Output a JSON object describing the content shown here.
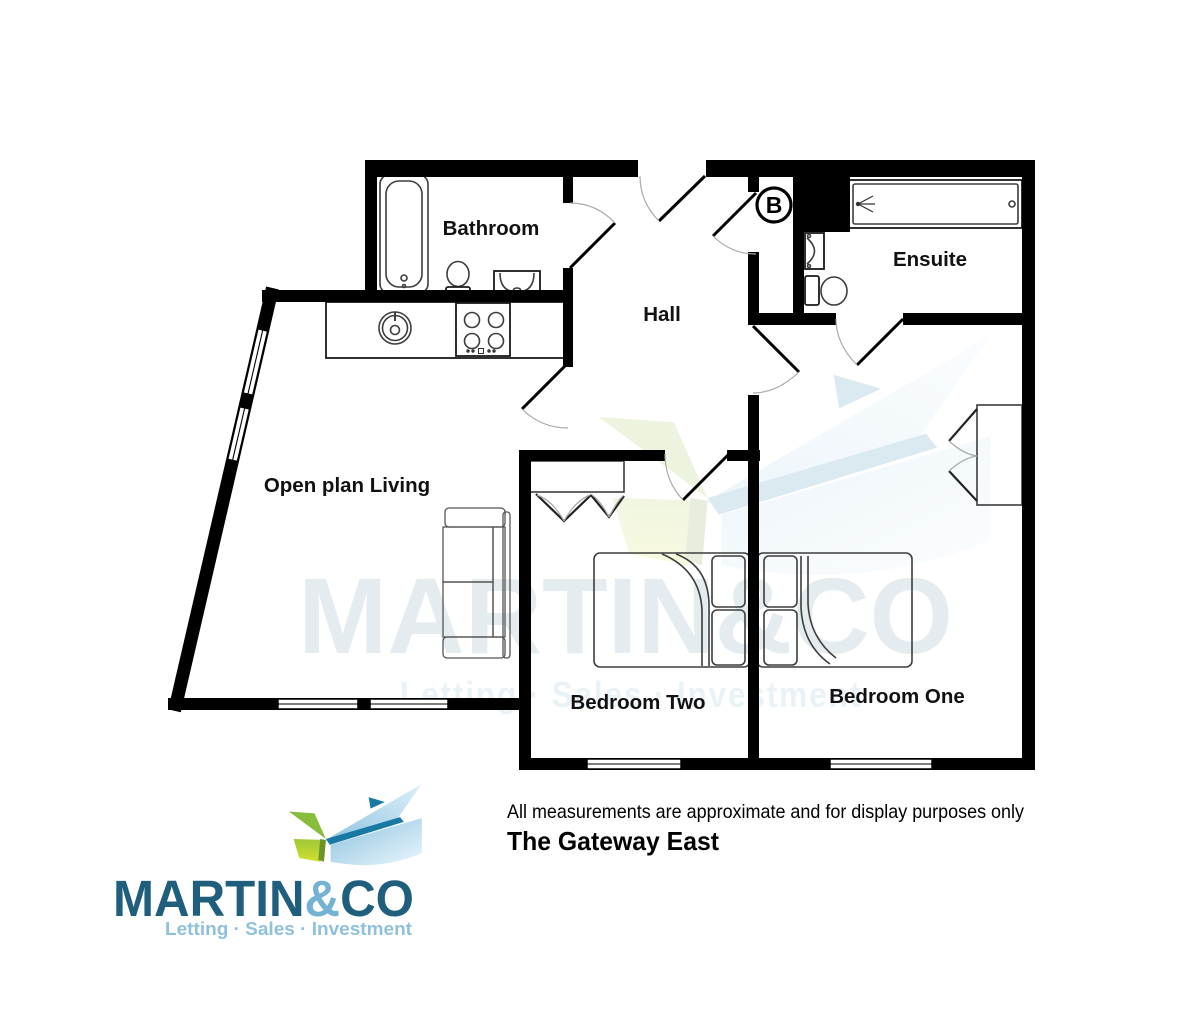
{
  "page": {
    "title": "The Gateway East",
    "disclaimer": "All measurements are approximate and for display purposes only"
  },
  "labels": {
    "bathroom": "Bathroom",
    "hall": "Hall",
    "ensuite": "Ensuite",
    "open_plan_living": "Open plan Living",
    "bedroom_two": "Bedroom Two",
    "bedroom_one": "Bedroom One",
    "boiler": "B"
  },
  "watermark": {
    "line1": "MARTIN&CO",
    "line2": "Letting · Sales · Investment"
  },
  "logo": {
    "word_main": "MARTIN",
    "word_amp": "&",
    "word_co": "CO",
    "tagline": "Letting · Sales · Investment"
  },
  "colors": {
    "wall": "#000000",
    "brand_teal": "#1f5f7d",
    "brand_amp_blue": "#74b2d3",
    "brand_tagline_blue": "#8fc0dd",
    "emblem_sail_blue": "#a9d2ea",
    "emblem_ridge_teal": "#1879a3",
    "emblem_leaf_green": "#86bd3a",
    "emblem_leaf_lime": "#c8da2f",
    "watermark_text": "#e4ecf0",
    "watermark_tagline": "#e9f2f7"
  }
}
